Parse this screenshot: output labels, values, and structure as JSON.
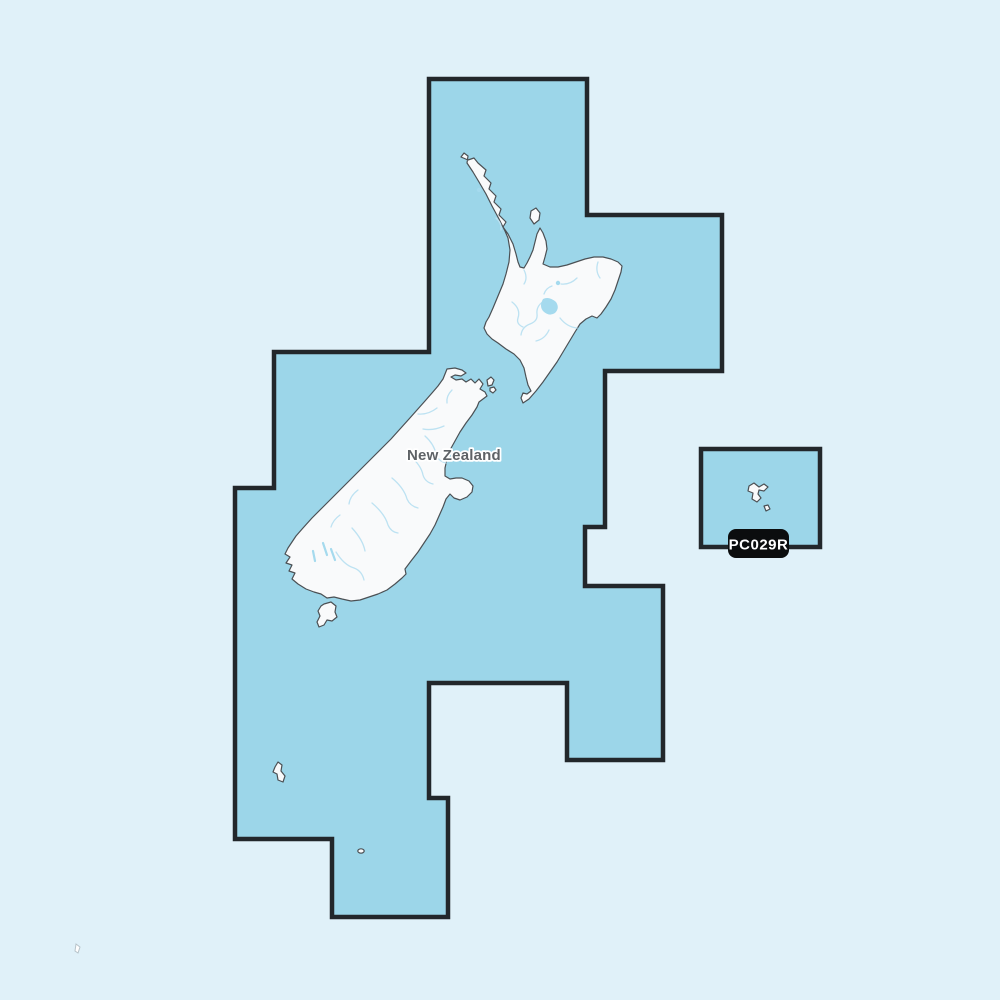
{
  "map": {
    "country_label": "New Zealand",
    "chart_id": "PC029R",
    "regions": {
      "main_coverage": "New Zealand mainland coverage area",
      "secondary_coverage": "Chatham Islands coverage area"
    },
    "colors": {
      "background": "#e0f1f9",
      "coverage_fill": "#9cd6e9",
      "coverage_border": "#22272b",
      "land_fill": "#f9fafb",
      "land_stroke": "#4b5054",
      "water_features": "#bde2f2",
      "lake_fill": "#a5daee",
      "label_text": "#5e6266",
      "badge_background": "#0b0d0e",
      "badge_text": "#ffffff"
    }
  }
}
